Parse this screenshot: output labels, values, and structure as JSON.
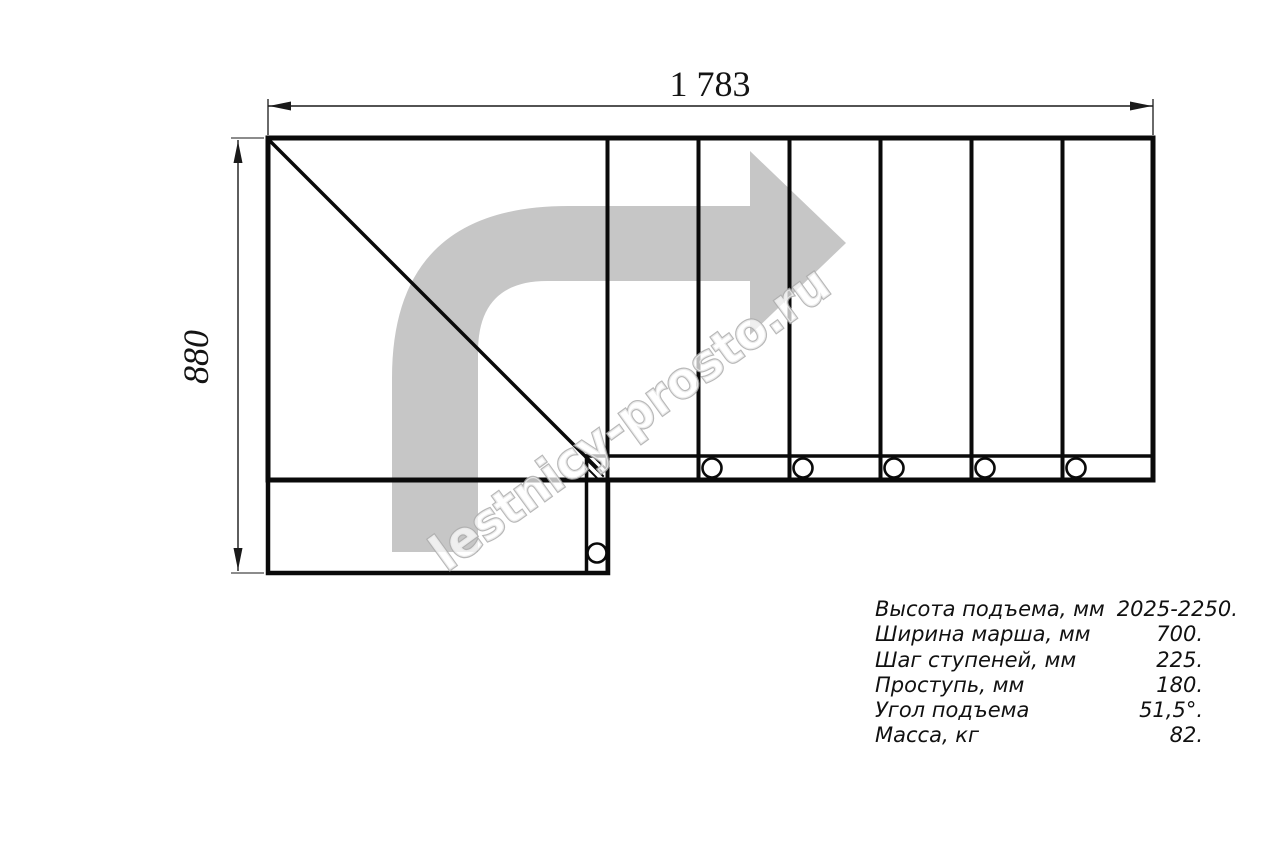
{
  "drawing": {
    "top_dimension": "1 783",
    "left_dimension": "880",
    "watermark": "lestnicy-prosto.ru",
    "colors": {
      "line": "#0a0a0a",
      "arrow": "#c6c6c6",
      "watermark_outline": "#ababab",
      "dimension": "#1a1a1a"
    }
  },
  "specs": {
    "rows": [
      {
        "label": "Высота подъема, мм",
        "value": "2025-2250."
      },
      {
        "label": "Ширина марша, мм",
        "value": "700."
      },
      {
        "label": "Шаг ступеней, мм",
        "value": "225."
      },
      {
        "label": "Проступь, мм",
        "value": "180."
      },
      {
        "label": "Угол подъема",
        "value": "51,5°."
      },
      {
        "label": "Масса, кг",
        "value": "82."
      }
    ]
  }
}
